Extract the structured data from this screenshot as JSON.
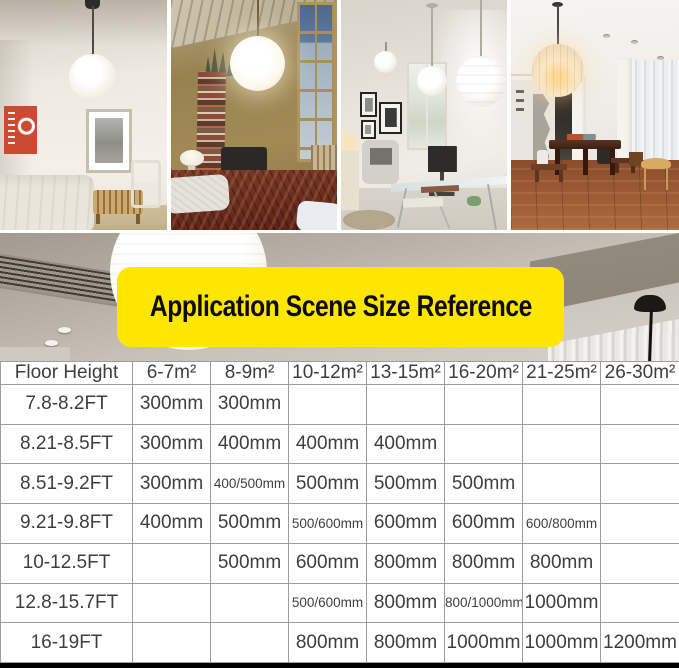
{
  "banner": {
    "label": "Application Scene Size Reference"
  },
  "colors": {
    "banner_bg": "#ffe502",
    "banner_text": "#0c0c0c",
    "table_border": "#9c9c9c",
    "table_text": "#3e3e3e",
    "footer_bar": "#000000"
  },
  "chart_data": {
    "type": "table",
    "title": "Application Scene Size Reference",
    "columns": [
      "Floor Height",
      "6-7m²",
      "8-9m²",
      "10-12m²",
      "13-15m²",
      "16-20m²",
      "21-25m²",
      "26-30m²"
    ],
    "rows": [
      {
        "label": "7.8-8.2FT",
        "values": [
          "300mm",
          "300mm",
          "",
          "",
          "",
          "",
          ""
        ]
      },
      {
        "label": "8.21-8.5FT",
        "values": [
          "300mm",
          "400mm",
          "400mm",
          "400mm",
          "",
          "",
          ""
        ]
      },
      {
        "label": "8.51-9.2FT",
        "values": [
          "300mm",
          "400/500mm",
          "500mm",
          "500mm",
          "500mm",
          "",
          ""
        ]
      },
      {
        "label": "9.21-9.8FT",
        "values": [
          "400mm",
          "500mm",
          "500/600mm",
          "600mm",
          "600mm",
          "600/800mm",
          ""
        ]
      },
      {
        "label": "10-12.5FT",
        "values": [
          "",
          "500mm",
          "600mm",
          "800mm",
          "800mm",
          "800mm",
          ""
        ]
      },
      {
        "label": "12.8-15.7FT",
        "values": [
          "",
          "",
          "500/600mm",
          "800mm",
          "800/1000mm",
          "1000mm",
          ""
        ]
      },
      {
        "label": "16-19FT",
        "values": [
          "",
          "",
          "800mm",
          "800mm",
          "1000mm",
          "1000mm",
          "1200mm"
        ]
      }
    ]
  }
}
